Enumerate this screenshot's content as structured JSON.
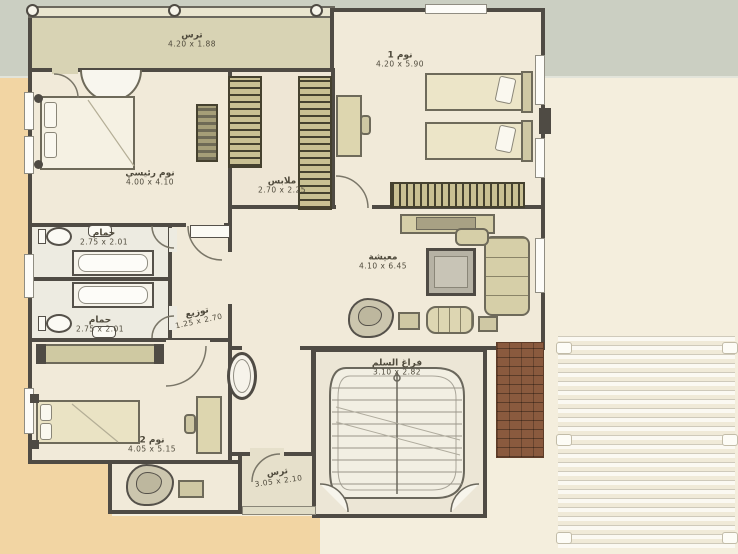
{
  "plan": {
    "rooms": {
      "terrace_top": {
        "name": "ترس",
        "dims": "4.20 x 1.88"
      },
      "bedroom1": {
        "name": "نوم 1",
        "dims": "4.20 x 5.90"
      },
      "master": {
        "name": "نوم رئيسي",
        "dims": "4.00 x 4.10"
      },
      "closet": {
        "name": "ملابس",
        "dims": "2.70 x 2.25"
      },
      "bath1": {
        "name": "حمام",
        "dims": "2.75 x 2.01"
      },
      "bath2": {
        "name": "حمام",
        "dims": "2.75 x 2.01"
      },
      "hall": {
        "name": "توزيع",
        "dims": "1.25 x 2.70"
      },
      "living": {
        "name": "معيشة",
        "dims": "4.10 x 6.45"
      },
      "stairwell": {
        "name": "فراغ السلم",
        "dims": "3.10 x 2.82"
      },
      "bedroom2": {
        "name": "نوم 2",
        "dims": "4.05 x 5.15"
      },
      "terrace_bottom": {
        "name": "ترس",
        "dims": "3.05 x 2.10"
      }
    },
    "colors": {
      "wall": "#4f4b44",
      "room_fill": "#f1ead9",
      "terrace_fill": "#d8d3b4",
      "bath_fill": "#edebe1",
      "band_top": "#cbcfc2",
      "margin_tan": "#f2d5a3",
      "paper_cream": "#f4eedd",
      "brick": "#8a5a3e",
      "furniture": "#ddd6af"
    }
  }
}
